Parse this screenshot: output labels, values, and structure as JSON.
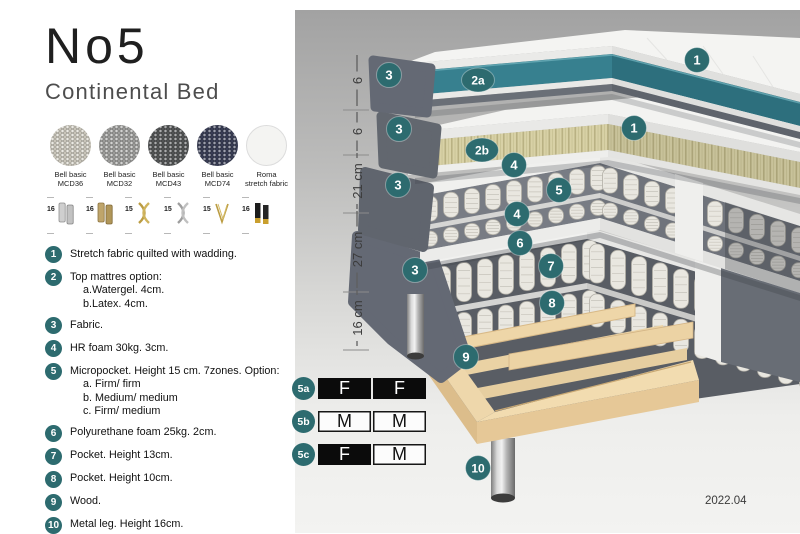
{
  "header": {
    "title": "No5",
    "subtitle": "Continental Bed"
  },
  "fabrics": [
    {
      "line1": "Bell basic",
      "line2": "MCD36",
      "color": "#d6d2c6",
      "textured": true
    },
    {
      "line1": "Bell basic",
      "line2": "MCD32",
      "color": "#a6a6a4",
      "textured": true
    },
    {
      "line1": "Bell basic",
      "line2": "MCD43",
      "color": "#57595a",
      "textured": true
    },
    {
      "line1": "Bell basic",
      "line2": "MCD74",
      "color": "#3c415a",
      "textured": true
    },
    {
      "line1": "Roma",
      "line2": "stretch fabric",
      "color": "#f4f4f2",
      "textured": false
    }
  ],
  "leg_options": [
    {
      "height": "16",
      "icon": "leg-cylinder-silver"
    },
    {
      "height": "16",
      "icon": "leg-cylinder-brass"
    },
    {
      "height": "15",
      "icon": "leg-cross-gold"
    },
    {
      "height": "15",
      "icon": "leg-cross-silver"
    },
    {
      "height": "15",
      "icon": "leg-hairpin-gold"
    },
    {
      "height": "16",
      "icon": "leg-cylinder-black-gold"
    }
  ],
  "spec_list": [
    {
      "num": "1",
      "text": "Stretch fabric quilted with wadding.",
      "subs": []
    },
    {
      "num": "2",
      "text": "Top mattres option:",
      "subs": [
        "a.Watergel. 4cm.",
        "b.Latex. 4cm."
      ]
    },
    {
      "num": "3",
      "text": "Fabric.",
      "subs": []
    },
    {
      "num": "4",
      "text": "HR foam 30kg. 3cm.",
      "subs": []
    },
    {
      "num": "5",
      "text": "Micropocket. Height 15 cm. 7zones. Option:",
      "subs": [
        "a. Firm/ firm",
        "b. Medium/ medium",
        "c. Firm/ medium"
      ]
    },
    {
      "num": "6",
      "text": "Polyurethane foam 25kg. 2cm.",
      "subs": []
    },
    {
      "num": "7",
      "text": "Pocket. Height 13cm.",
      "subs": []
    },
    {
      "num": "8",
      "text": "Pocket. Height 10cm.",
      "subs": []
    },
    {
      "num": "9",
      "text": "Wood.",
      "subs": []
    },
    {
      "num": "10",
      "text": "Metal leg. Height 16cm.",
      "subs": []
    }
  ],
  "diagram": {
    "ruler": [
      {
        "label": "6",
        "y1": 45,
        "y2": 96,
        "gap": 9
      },
      {
        "label": "6",
        "y1": 102,
        "y2": 141,
        "gap": 9
      },
      {
        "label": "21 cm",
        "y1": 143,
        "y2": 199,
        "gap": 23
      },
      {
        "label": "27 cm",
        "y1": 201,
        "y2": 278,
        "gap": 23
      },
      {
        "label": "16 cm",
        "y1": 280,
        "y2": 336,
        "gap": 23
      }
    ],
    "callouts": [
      {
        "label": "1",
        "x": 402,
        "y": 50,
        "wide": false
      },
      {
        "label": "3",
        "x": 94,
        "y": 65,
        "wide": false
      },
      {
        "label": "2a",
        "x": 183,
        "y": 70,
        "wide": true
      },
      {
        "label": "1",
        "x": 339,
        "y": 118,
        "wide": false
      },
      {
        "label": "3",
        "x": 104,
        "y": 119,
        "wide": false
      },
      {
        "label": "2b",
        "x": 187,
        "y": 140,
        "wide": true
      },
      {
        "label": "4",
        "x": 219,
        "y": 155,
        "wide": false
      },
      {
        "label": "3",
        "x": 103,
        "y": 175,
        "wide": false
      },
      {
        "label": "5",
        "x": 264,
        "y": 180,
        "wide": false
      },
      {
        "label": "4",
        "x": 222,
        "y": 204,
        "wide": false
      },
      {
        "label": "6",
        "x": 225,
        "y": 233,
        "wide": false
      },
      {
        "label": "3",
        "x": 120,
        "y": 260,
        "wide": false
      },
      {
        "label": "7",
        "x": 256,
        "y": 256,
        "wide": false
      },
      {
        "label": "8",
        "x": 257,
        "y": 293,
        "wide": false
      },
      {
        "label": "9",
        "x": 171,
        "y": 347,
        "wide": false
      },
      {
        "label": "10",
        "x": 183,
        "y": 458,
        "wide": false
      }
    ]
  },
  "firmness_table": {
    "rows": [
      {
        "label": "5a",
        "top": 367,
        "cells": [
          {
            "text": "F",
            "variant": "dark"
          },
          {
            "text": "F",
            "variant": "dark"
          }
        ]
      },
      {
        "label": "5b",
        "top": 400,
        "cells": [
          {
            "text": "M",
            "variant": "light"
          },
          {
            "text": "M",
            "variant": "light"
          }
        ]
      },
      {
        "label": "5c",
        "top": 433,
        "cells": [
          {
            "text": "F",
            "variant": "dark"
          },
          {
            "text": "M",
            "variant": "light"
          }
        ]
      }
    ]
  },
  "footer": {
    "version": "2022.04"
  },
  "colors": {
    "accent_teal": "#2d6b6f",
    "watergel": "#37808f",
    "watergel_dark": "#2d6f7d",
    "latex": "#d8d1a6",
    "wood": "#eed7ab",
    "fabric_gray": "#646974"
  }
}
